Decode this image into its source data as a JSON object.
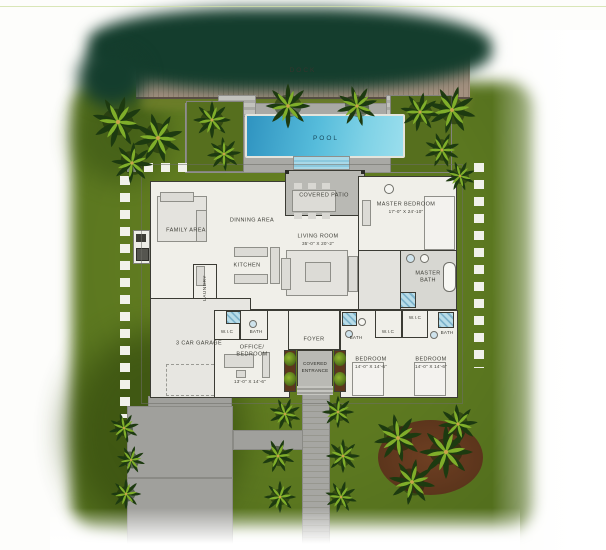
{
  "site": {
    "dock": "DOCK",
    "pool": "POOL"
  },
  "labels": {
    "covered_patio": "COVERED PATIO",
    "family_area": "FAMILY AREA",
    "dinning_area": "DINNING AREA",
    "kitchen": "KITCHEN",
    "living_room": "LIVING ROOM",
    "living_room_dims": "35'-0\" X 20'-2\"",
    "master_bedroom": "MASTER BEDROOM",
    "master_bedroom_dims": "17'-0\" X 24'-10\"",
    "master_bath_l1": "MASTER",
    "master_bath_l2": "BATH",
    "laundry": "LAUNDRY",
    "garage": "3 CAR GARAGE",
    "wic_office": "W.I.C",
    "bath_office": "BATH",
    "office_l1": "OFFICE/",
    "office_l2": "BEDROOM",
    "office_dims": "13'-0\" X 14'-6\"",
    "foyer": "FOYER",
    "covered_entrance_l1": "COVERED",
    "covered_entrance_l2": "ENTRANCE",
    "bath_bed2": "BATH",
    "wic_bed2": "W.I.C",
    "bedroom2": "BEDROOM",
    "bedroom2_dims": "14'-0\" X 14'-6\"",
    "wic_bed3": "W.I.C",
    "bath_bed3": "BATH",
    "bedroom3": "BEDROOM",
    "bedroom3_dims": "14'-0\" X 14'-6\""
  },
  "colors": {
    "lawn": "#5e7a20",
    "lawn_shadow": "#3a5110",
    "hedge": "#143d2d",
    "dock_wood": "#9c8878",
    "pool_water": "#57bfdd",
    "pool_deck": "#a9a9a5",
    "patio": "#b9b9b4",
    "floor": "#f0efe9",
    "wall": "#3b3b34",
    "driveway": "#a0a09c",
    "mulch": "#643a1f",
    "stepping_stone": "#f1f1ea",
    "palm_dark": "#1d3a10",
    "palm_light": "#7fae2a"
  }
}
